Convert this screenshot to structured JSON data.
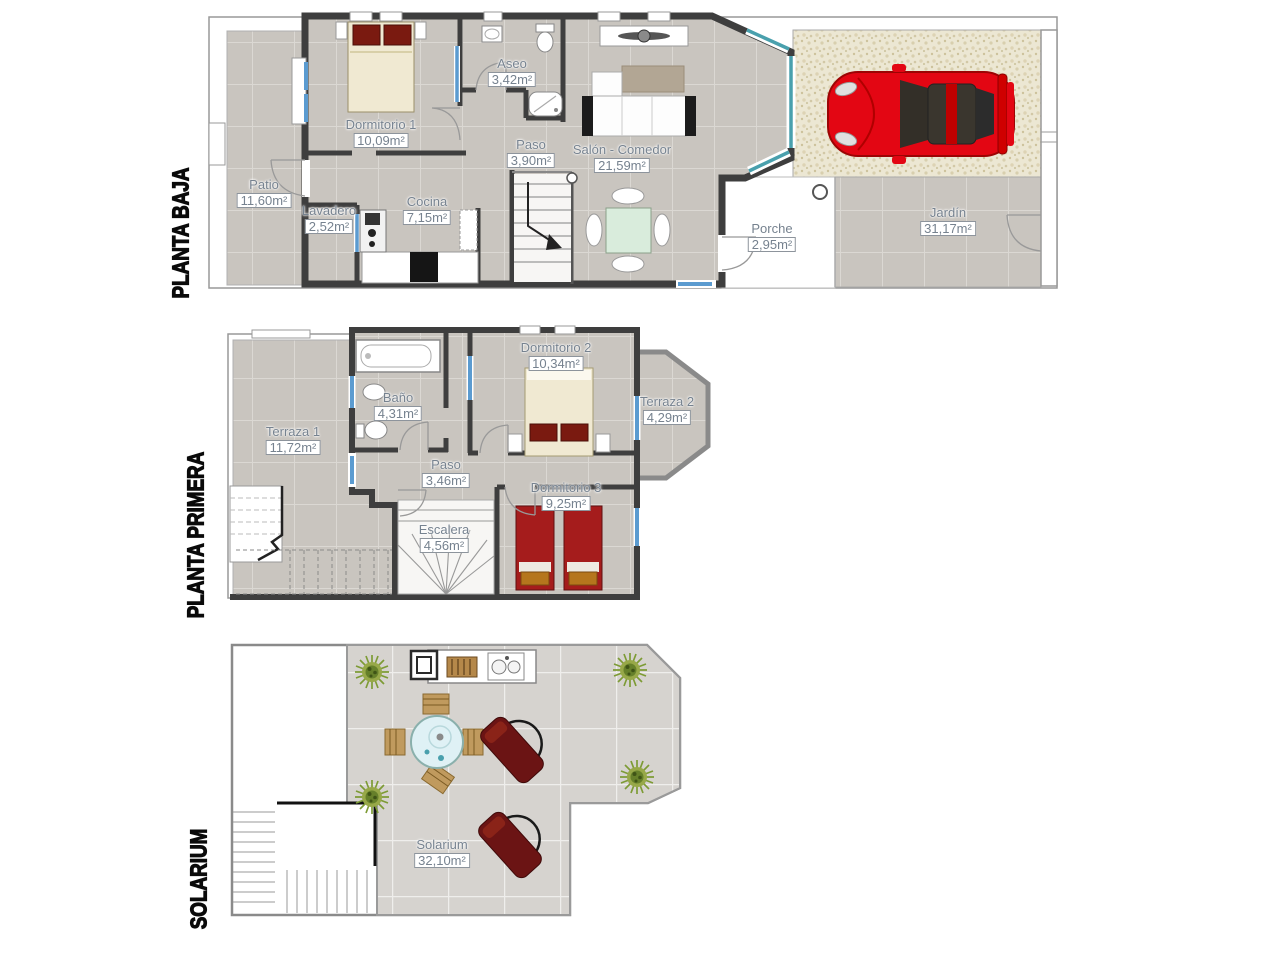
{
  "document_type": "floor-plan",
  "floors": [
    {
      "id": "planta-baja",
      "title": "PLANTA BAJA",
      "rooms": [
        {
          "name": "Dormitorio 1",
          "area": "10,09m²"
        },
        {
          "name": "Aseo",
          "area": "3,42m²"
        },
        {
          "name": "Paso",
          "area": "3,90m²"
        },
        {
          "name": "Salón - Comedor",
          "area": "21,59m²"
        },
        {
          "name": "Patio",
          "area": "11,60m²"
        },
        {
          "name": "Lavadero",
          "area": "2,52m²"
        },
        {
          "name": "Cocina",
          "area": "7,15m²"
        },
        {
          "name": "Porche",
          "area": "2,95m²"
        },
        {
          "name": "Jardín",
          "area": "31,17m²"
        }
      ]
    },
    {
      "id": "planta-primera",
      "title": "PLANTA PRIMERA",
      "rooms": [
        {
          "name": "Terraza 1",
          "area": "11,72m²"
        },
        {
          "name": "Baño",
          "area": "4,31m²"
        },
        {
          "name": "Dormitorio 2",
          "area": "10,34m²"
        },
        {
          "name": "Terraza 2",
          "area": "4,29m²"
        },
        {
          "name": "Paso",
          "area": "3,46m²"
        },
        {
          "name": "Dormitorio 3",
          "area": "9,25m²"
        },
        {
          "name": "Escalera",
          "area": "4,56m²"
        }
      ]
    },
    {
      "id": "solarium",
      "title": "SOLARIUM",
      "rooms": [
        {
          "name": "Solarium",
          "area": "32,10m²"
        }
      ]
    }
  ],
  "colors": {
    "label_text": "#76828f",
    "label_box_border": "#8d949c",
    "wall_dark": "#3e3e3e",
    "tile_floor": "#c9c5bf",
    "tile_grout": "#dbd8d3",
    "solarium_tile": "#d6d3cf",
    "gravel_bg": "#ece7d3",
    "window_blue": "#5b9bd0",
    "bay_glass_teal": "#49a0ad",
    "car_red": "#e30613",
    "lounger_red": "#6b1414",
    "bed_red": "#a51c1c",
    "pillow_red": "#7a1a10",
    "bed_cream": "#f0e9d2",
    "plant_green": "#7d9b35",
    "round_table_glass": "#dff1f5",
    "dining_table_glass": "#d9ecdc"
  }
}
